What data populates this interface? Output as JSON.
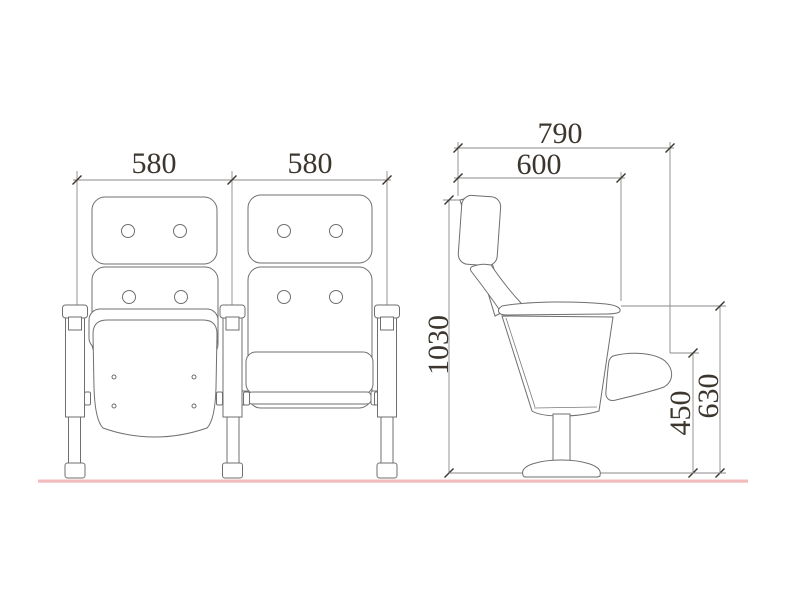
{
  "drawing": {
    "type": "technical-drawing-auditorium-chair",
    "colors": {
      "background": "#ffffff",
      "object_lines": "#6f6f6f",
      "dimension_lines": "#8a8a8a",
      "dimension_text": "#3c362e",
      "floor_line": "#f2bcbc"
    },
    "front_view": {
      "left_chair_width_label": "580",
      "right_chair_width_label": "580"
    },
    "side_view": {
      "overall_depth_label": "790",
      "seat_depth_label": "600",
      "overall_height_label": "1030",
      "armrest_height_label": "450",
      "seat_top_height_label": "630"
    }
  }
}
